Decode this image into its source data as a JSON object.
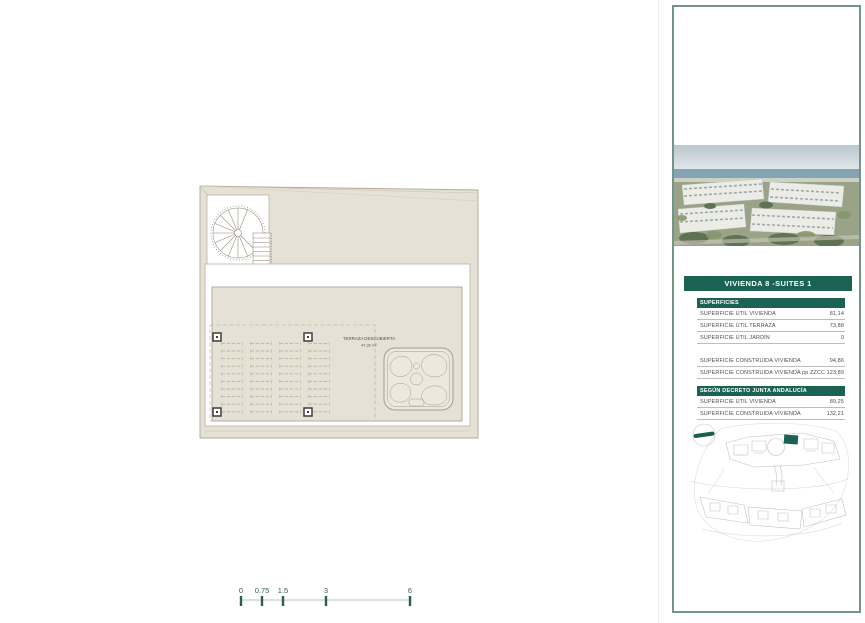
{
  "page": {
    "background": "#ffffff"
  },
  "plan": {
    "room_label": "TERRAZA DESCUBIERTA",
    "room_area": "47,32 m²",
    "colors": {
      "roof_fill": "#e6e1d5",
      "line": "#b1a999",
      "post": "#413e38",
      "accent": "#1a6353"
    }
  },
  "scale_bar": {
    "labels": [
      "0",
      "0.75",
      "1.5",
      "3",
      "6"
    ],
    "tick_color": "#2c5e50"
  },
  "sidebar": {
    "border_color": "#72958a",
    "title": "VIVIENDA 8 -SUITES 1",
    "photo_name": "aerial-photo-residential-complex-sea-view",
    "sections": [
      {
        "header": "SUPERFICIES",
        "rows": [
          {
            "label": "SUPERFICIE ÚTIL VIVIENDA",
            "value": "81,14"
          },
          {
            "label": "SUPERFICIE ÚTIL TERRAZA",
            "value": "73,88"
          },
          {
            "label": "SUPERFICIE ÚTIL JARDÍN",
            "value": "0"
          }
        ]
      },
      {
        "header": "",
        "rows": [
          {
            "label": "SUPERFICIE CONSTRUIDA VIVIENDA",
            "value": "94,86"
          },
          {
            "label": "SUPERFICIE CONSTRUIDA VIVIENDA pp.ZZCC",
            "value": "123,89"
          }
        ]
      },
      {
        "header": "SEGÚN DECRETO JUNTA ANDALUCÍA",
        "rows": [
          {
            "label": "SUPERFICIE ÚTIL VIVIENDA",
            "value": "89,25"
          },
          {
            "label": "SUPERFICIE CONSTRUIDA VIVIENDA",
            "value": "132,21"
          }
        ]
      }
    ]
  }
}
